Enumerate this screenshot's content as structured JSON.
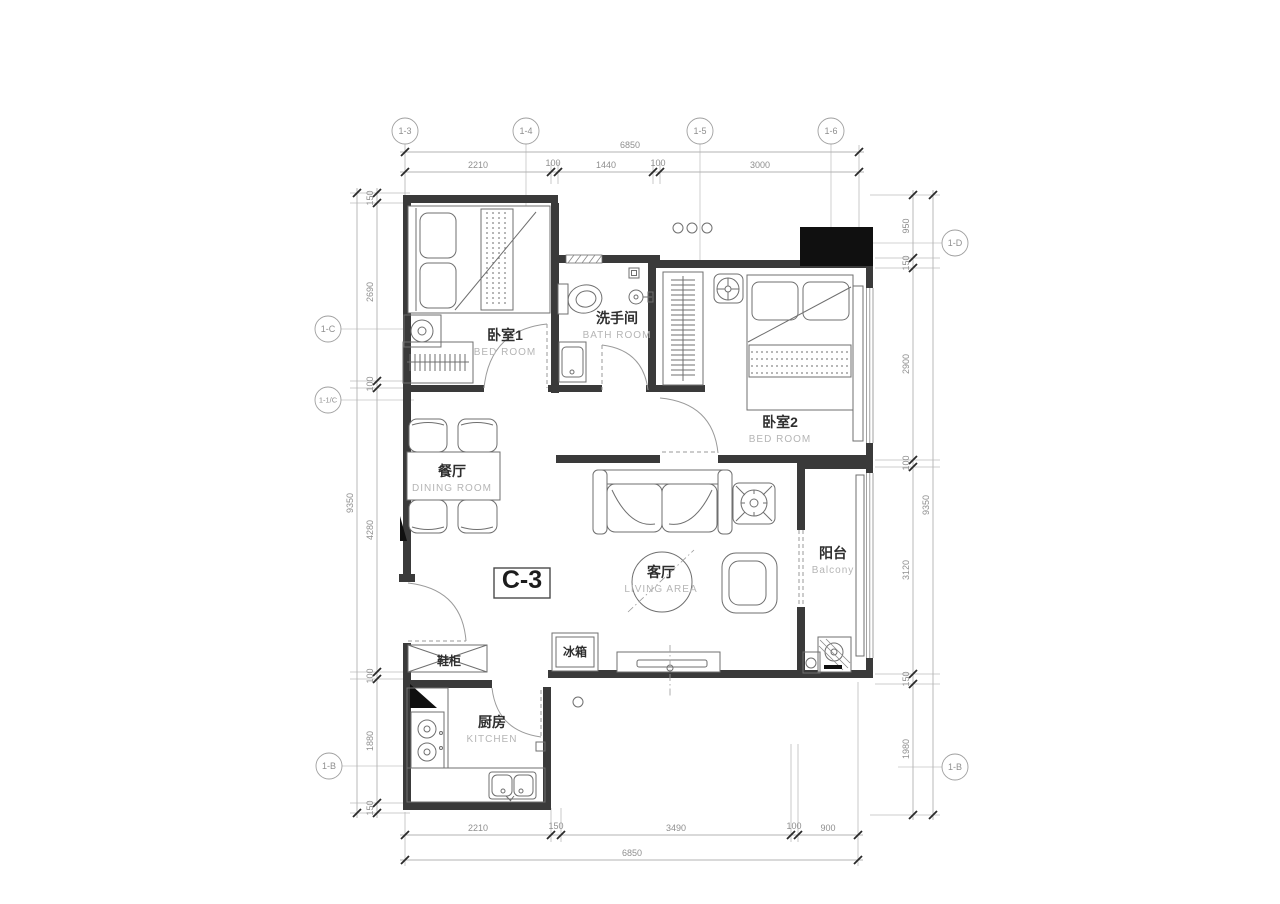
{
  "plan": {
    "unit_label": "C-3",
    "rooms": {
      "bedroom1": {
        "cn": "卧室1",
        "en": "BED ROOM"
      },
      "bathroom": {
        "cn": "洗手间",
        "en": "BATH ROOM"
      },
      "bedroom2": {
        "cn": "卧室2",
        "en": "BED ROOM"
      },
      "dining": {
        "cn": "餐厅",
        "en": "DINING ROOM"
      },
      "living": {
        "cn": "客厅",
        "en": "LIVING AREA"
      },
      "balcony": {
        "cn": "阳台",
        "en": "Balcony"
      },
      "kitchen": {
        "cn": "厨房",
        "en": "KITCHEN"
      }
    },
    "fixtures": {
      "shoe_cabinet": "鞋柜",
      "fridge": "冰箱"
    }
  },
  "grid": {
    "top": [
      "1-3",
      "1-4",
      "1-5",
      "1-6"
    ],
    "left": [
      "1-C",
      "1-1/C",
      "1-B"
    ],
    "right": [
      "1-D",
      "1-B"
    ]
  },
  "dims": {
    "top": {
      "overall": "6850",
      "segments": [
        "2210",
        "100",
        "1440",
        "100",
        "3000"
      ]
    },
    "bottom": {
      "overall": "6850",
      "segments": [
        "2210",
        "150",
        "3490",
        "100",
        "900"
      ]
    },
    "left": {
      "overall": "9350",
      "segments": [
        "150",
        "2690",
        "100",
        "4280",
        "100",
        "1880",
        "150"
      ]
    },
    "right": {
      "overall": "9350",
      "segments": [
        "950",
        "150",
        "2900",
        "100",
        "3120",
        "150",
        "1980"
      ]
    }
  }
}
